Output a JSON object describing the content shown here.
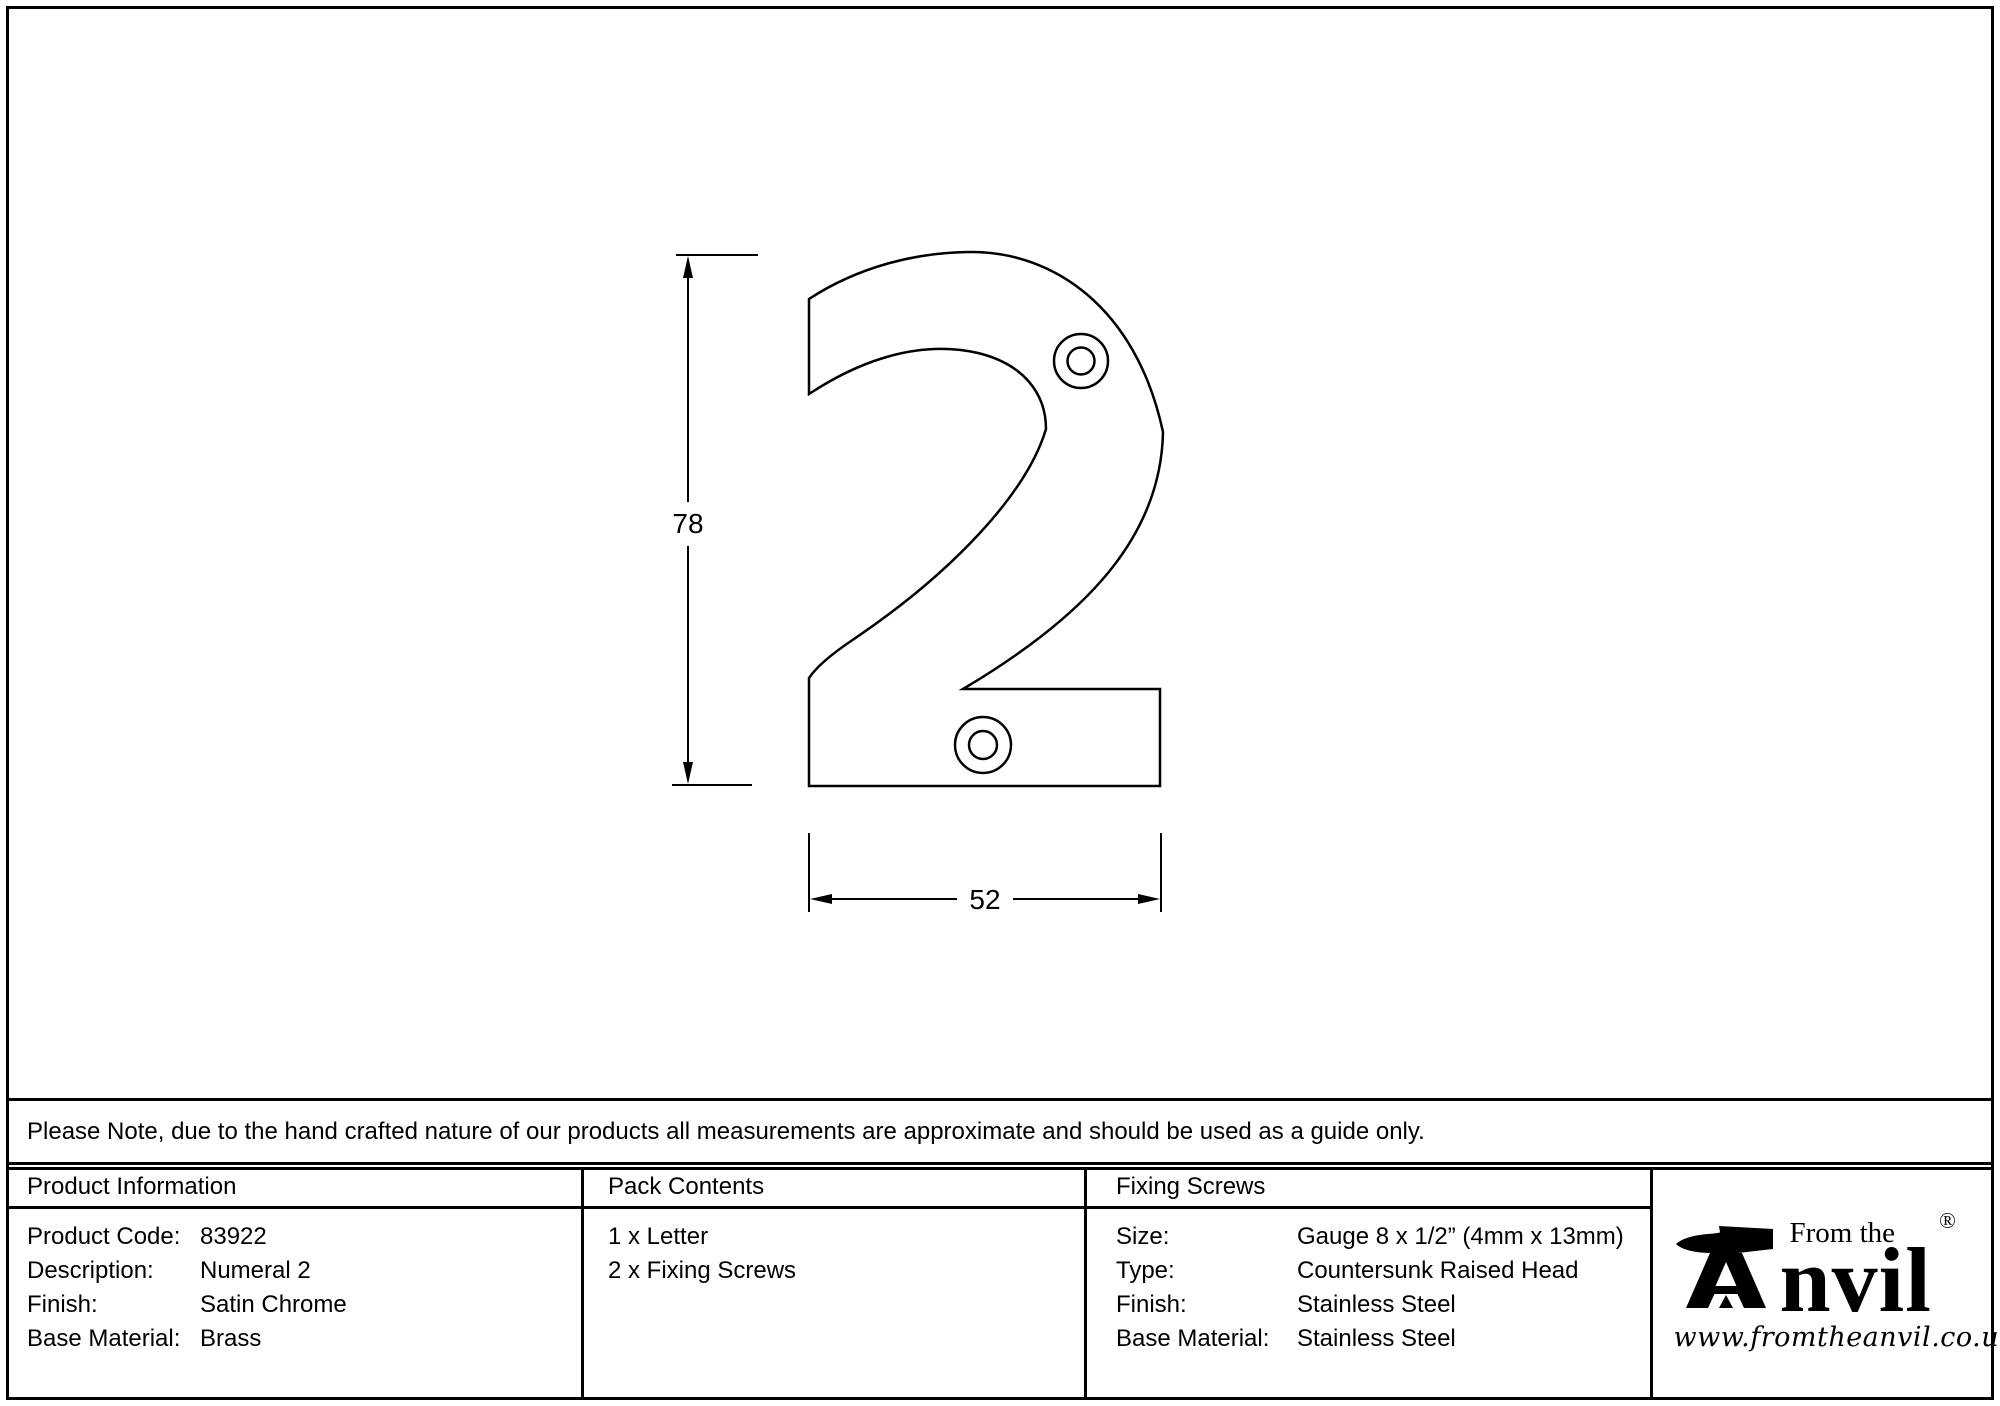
{
  "drawing": {
    "height_dim": "78",
    "width_dim": "52"
  },
  "notice": {
    "text": "Please Note, due to the hand crafted nature of our products all measurements are approximate and should be used as a guide only."
  },
  "table": {
    "product_information": {
      "header": "Product Information",
      "rows": [
        {
          "label": "Product Code:",
          "value": "83922"
        },
        {
          "label": "Description:",
          "value": "Numeral 2"
        },
        {
          "label": "Finish:",
          "value": "Satin Chrome"
        },
        {
          "label": "Base Material:",
          "value": "Brass"
        }
      ]
    },
    "pack_contents": {
      "header": "Pack Contents",
      "items": [
        "1 x Letter",
        "2 x Fixing Screws"
      ]
    },
    "fixing_screws": {
      "header": "Fixing Screws",
      "rows": [
        {
          "label": "Size:",
          "value": "Gauge 8 x 1/2” (4mm x 13mm)"
        },
        {
          "label": "Type:",
          "value": "Countersunk Raised Head"
        },
        {
          "label": "Finish:",
          "value": "Stainless Steel"
        },
        {
          "label": "Base Material:",
          "value": "Stainless Steel"
        }
      ]
    }
  },
  "logo": {
    "tagline": "From the",
    "brand_suffix": "nvil",
    "registered": "®",
    "website": "www.fromtheanvil.co.uk"
  }
}
